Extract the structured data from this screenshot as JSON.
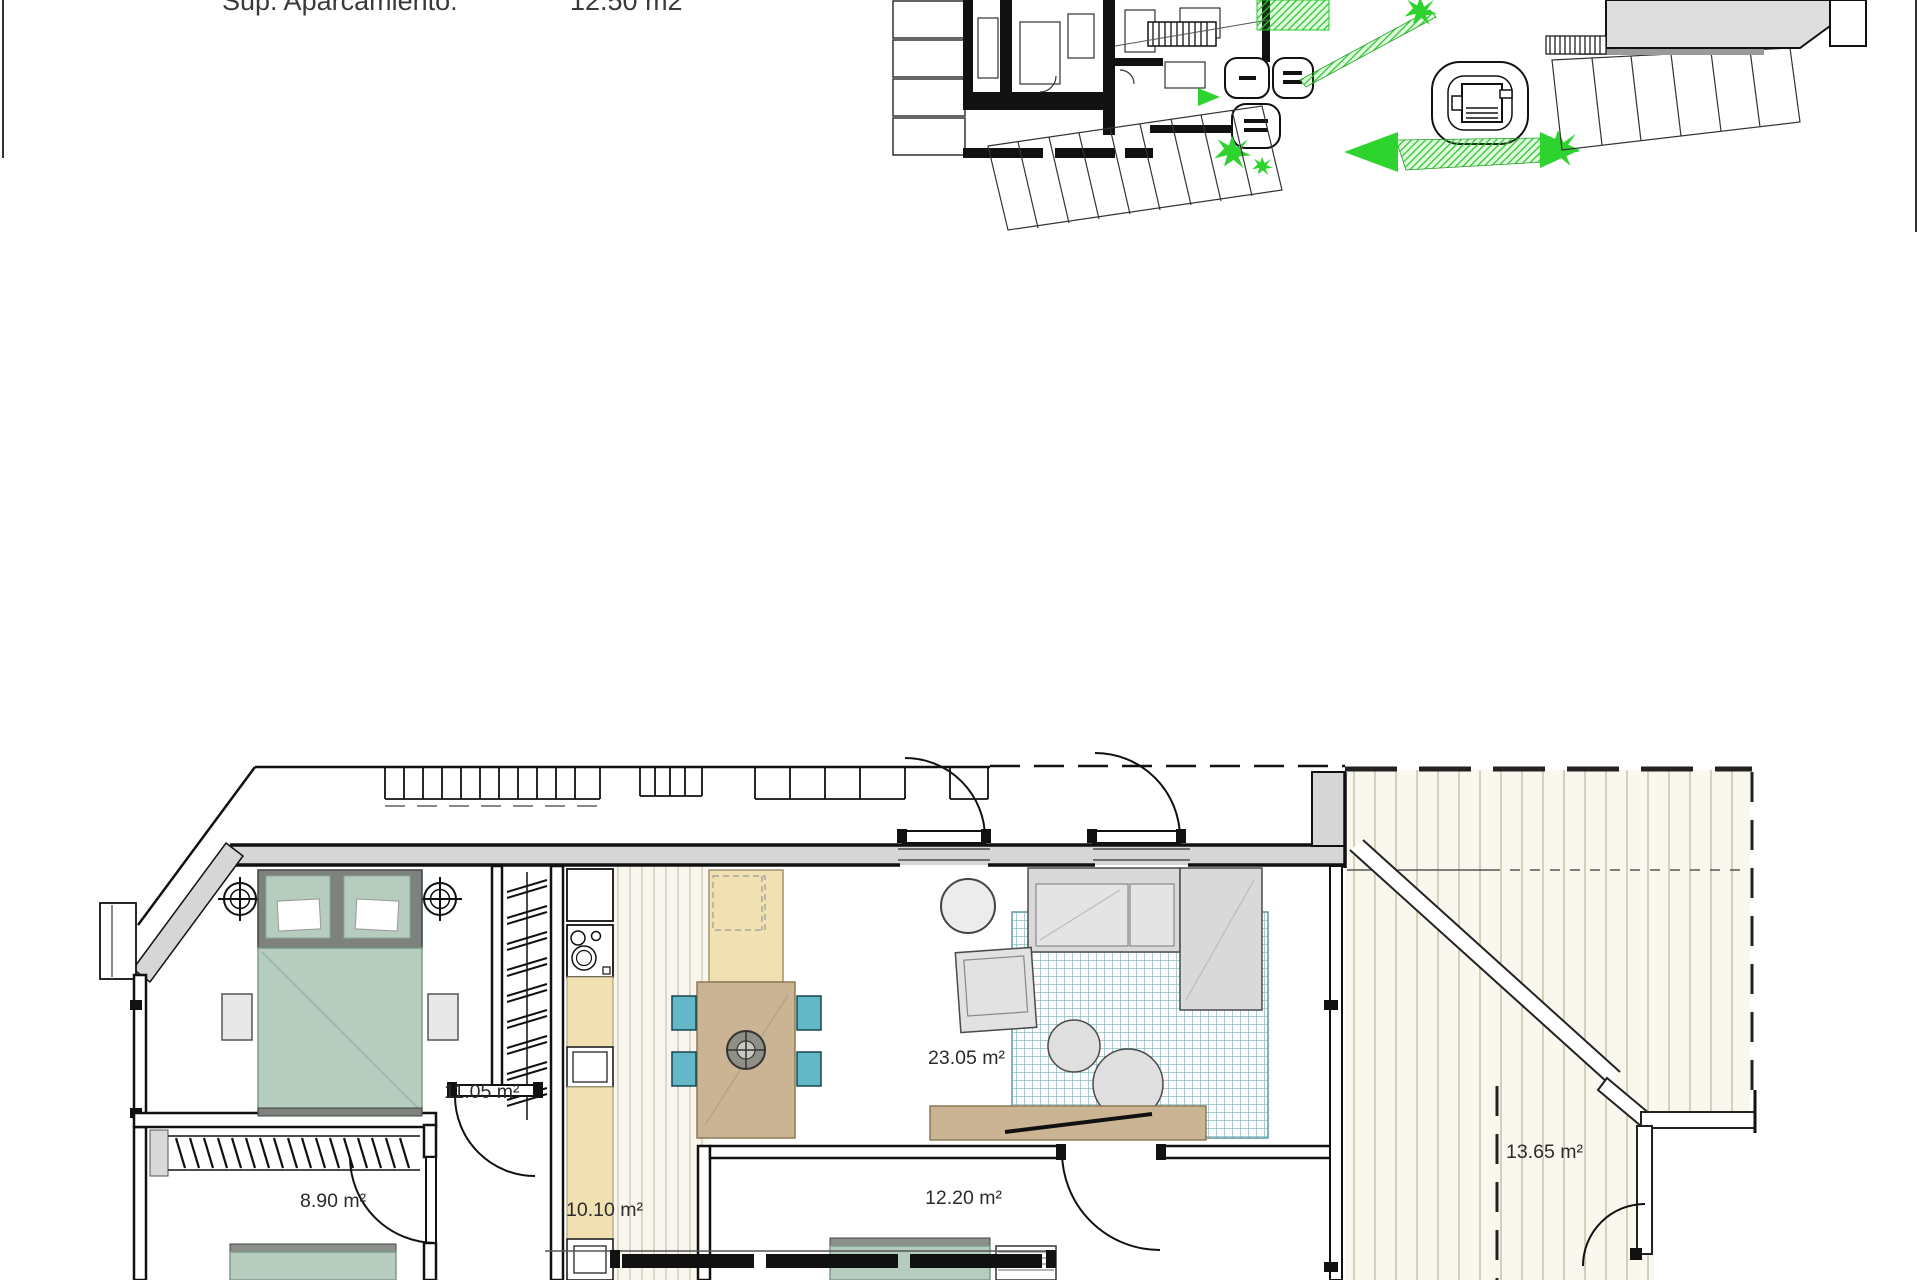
{
  "header": {
    "label": "Sup. Aparcamiento:",
    "value": "12.50 m2"
  },
  "floor_plan": {
    "rooms": [
      {
        "id": "bedroom-1",
        "area_label": "11.05 m²"
      },
      {
        "id": "bedroom-2",
        "area_label": "8.90 m²"
      },
      {
        "id": "hallway",
        "area_label": "10.10 m²"
      },
      {
        "id": "living-dining",
        "area_label": "23.05 m²"
      },
      {
        "id": "bedroom-3",
        "area_label": "12.20 m²"
      },
      {
        "id": "terrace",
        "area_label": "13.65 m²"
      }
    ]
  },
  "colors": {
    "sage": "#b5ccbf",
    "teal": "#62b8c7",
    "cream": "#f0e0b2",
    "wood": "#cbb493",
    "wall_gray": "#d6d6d6",
    "deck_stripe": "#c6c2aa",
    "site_green": "#2fd32f",
    "rug_teal": "#7fb7c0",
    "label_text": "#2b2b2b"
  }
}
